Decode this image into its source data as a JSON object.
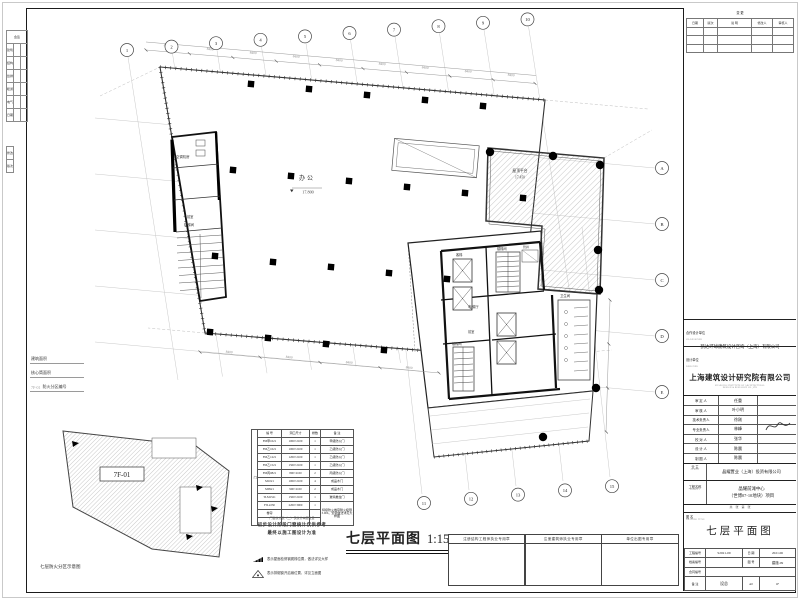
{
  "sheet": {
    "main_title": "七层平面图",
    "main_scale": "1:150",
    "keyplan_caption": "七层防火分区示意图",
    "keyplan_zone": "7F-01",
    "legend": {
      "l1": "建筑面积",
      "l2": "核心筒面积",
      "l3_code": "7F-01",
      "l3": "防火分区编号"
    },
    "binding": {
      "title": "会签",
      "rows": [
        [
          "建筑",
          ""
        ],
        [
          "结构",
          ""
        ],
        [
          "给排",
          ""
        ],
        [
          "暖通",
          ""
        ],
        [
          "电气",
          ""
        ],
        [
          "日期",
          ""
        ]
      ],
      "rev1": "修改",
      "rev2": "版次"
    }
  },
  "schedule": {
    "side_label": "门",
    "headers": [
      "编 号",
      "洞口尺寸",
      "樘数",
      "备 注"
    ],
    "rows": [
      [
        "FM甲1021",
        "1000×2100",
        "1",
        "甲级防火门"
      ],
      [
        "FM乙1021",
        "1000×2100",
        "1",
        "乙级防火门"
      ],
      [
        "FM乙1221",
        "1200×2100",
        "1",
        "乙级防火门"
      ],
      [
        "FM乙1521",
        "1500×2100",
        "1",
        "乙级防火门"
      ],
      [
        "FM丙0821",
        "800×2100",
        "2",
        "丙级防火门"
      ],
      [
        "M1021",
        "1000×2100",
        "4",
        "成品木门"
      ],
      [
        "M0921",
        "900×2100",
        "2",
        "成品木门"
      ],
      [
        "TLM1521",
        "1500×2100",
        "1",
        "玻璃推拉门"
      ]
    ],
    "footer_label": "卷帘",
    "footer": {
      "code": "FJL2230",
      "size": "2200×3000",
      "qty": "1",
      "remark": "特级防火卷帘耐火极限3.00h，安装做法详见大样图"
    },
    "note_top": "门窗统计表（二）仅统计本层数量",
    "note_b1": "初步设计阶段门窗统计仅供参考",
    "note_b2": "最终以施工图设计为准",
    "sym_note1": "表示屋面检修钢爬梯位置，做法详见大样",
    "sym_note2": "表示排烟窗开启扇位置，详见立面图"
  },
  "stamps": {
    "s1": "注册结构工程师执业专用章",
    "s2": "注册建筑师执业专用章",
    "s3": "单位出图专用章"
  },
  "titleblock": {
    "rev_mark": "变 更",
    "rev_headers": [
      "日期",
      "版次",
      "说 明",
      "修改人",
      "审核人"
    ],
    "co_label": "合作设计单位",
    "co_sub": "CO-DESIGNER",
    "co_name": "凯达环球建筑设计咨询（上海）有限公司",
    "de_label": "设计单位",
    "de_sub": "DESIGNER",
    "de_name": "上海建筑设计研究院有限公司",
    "de_en1": "SHANGHAI INSTITUTE OF ARCHITECTURAL",
    "de_en2": "DESIGN & RESEARCH CO.,LTD",
    "personnel": [
      [
        "审 定 人",
        "任重"
      ],
      [
        "审 核 人",
        "叶小明"
      ],
      [
        "技术负责人",
        "徐刚"
      ],
      [
        "专业负责人",
        "林峰"
      ],
      [
        "校 对 人",
        "张华"
      ],
      [
        "设 计 人",
        "陈晨"
      ],
      [
        "制 图 人",
        "陈晨"
      ]
    ],
    "client_label": "业 主",
    "client_sub": "CLIENT",
    "client": "晶耀置业（上海）投资有限公司",
    "project_label": "工程名称",
    "project_sub": "PROJECT",
    "project1": "晶耀前滩中心",
    "project2": "（世博07-10地块）项目",
    "pages": "共　张　第　张",
    "title_label": "图 名",
    "title_sub": "DRAWING TITLE",
    "title": "七层平面图",
    "f_job_label": "工程编号",
    "f_job": "S2021-09",
    "f_date_label": "日 期",
    "f_date": "2021.06",
    "f_arc_label": "档案编号",
    "f_arc": "",
    "f_dwg_label": "图 号",
    "f_dwg": "建施-09",
    "f_ctr_label": "合同编号",
    "f_ctr": "",
    "f_note_label": "备 注",
    "f_note": "设总",
    "f_size": "A0",
    "f_page": "1F"
  },
  "plan": {
    "office": "办公",
    "office_level": "17.800",
    "terrace": "屋顶平台",
    "terrace_level": "17.450",
    "dim": "8400",
    "rooms": {
      "ahu": "空调机房",
      "lobby1": "前室",
      "stair_l": "楼梯间",
      "elev_hall": "电梯厅",
      "lift": "客梯",
      "stair1": "楼梯间",
      "stair2": "楼梯间",
      "wc": "卫生间",
      "lobby2": "前室",
      "shaft": "管井"
    },
    "grid_top": [
      "1",
      "2",
      "3",
      "4",
      "5",
      "6",
      "7",
      "8",
      "9",
      "10"
    ],
    "grid_bottom": [
      "11",
      "12",
      "13",
      "14",
      "15"
    ],
    "grid_right": [
      "A",
      "B",
      "C",
      "D",
      "E"
    ]
  }
}
